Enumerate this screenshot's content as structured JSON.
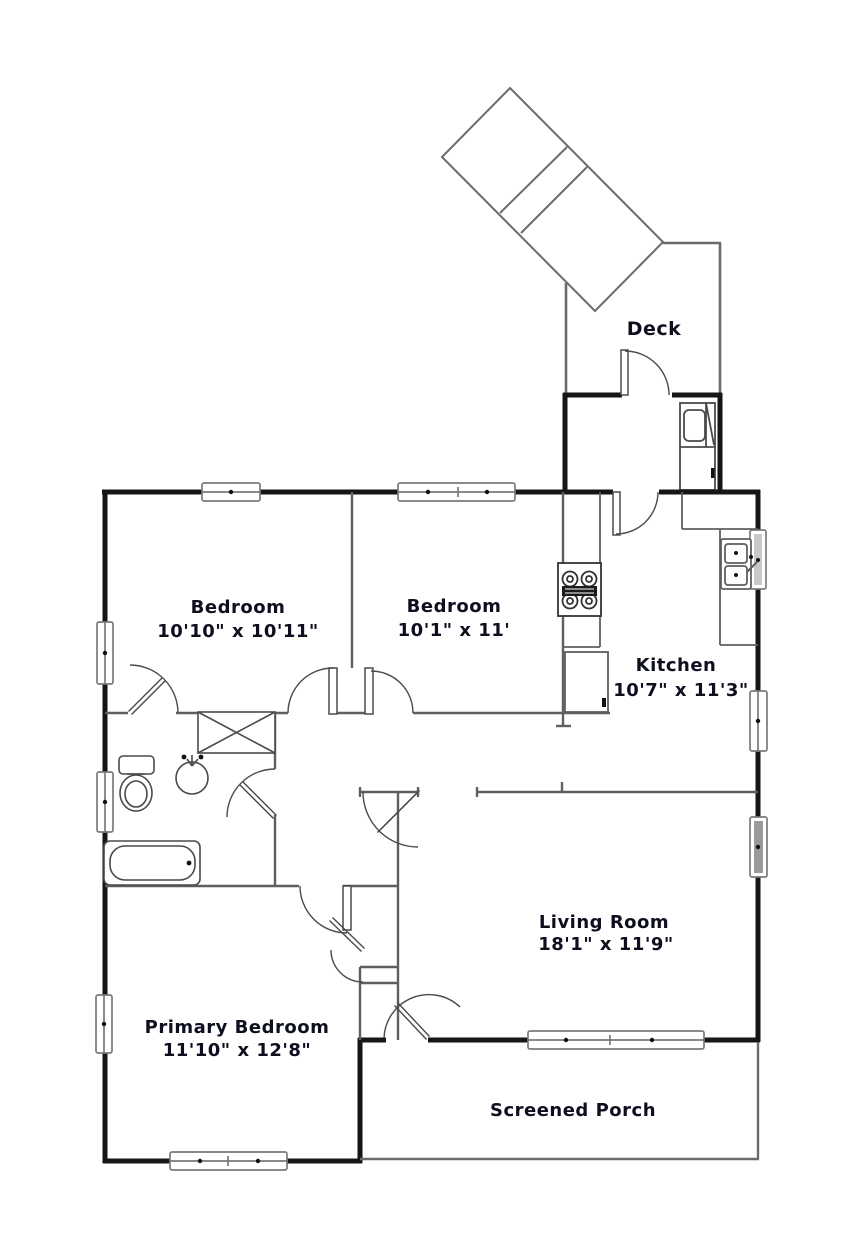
{
  "title": "Floor plan",
  "colors": {
    "outer_wall": "#161616",
    "interior_wall": "#5f5f5f",
    "fixture": "#4a4a4a",
    "label": "#0d0f1f",
    "window_frame": "#7a7a7a",
    "shaded_window": "#9a9a9a"
  },
  "rooms": {
    "deck": {
      "name": "Deck"
    },
    "bedroom1": {
      "name": "Bedroom",
      "dims": "10'10\" x 10'11\""
    },
    "bedroom2": {
      "name": "Bedroom",
      "dims": "10'1\" x 11'"
    },
    "kitchen": {
      "name": "Kitchen",
      "dims": "10'7\" x 11'3\""
    },
    "living_room": {
      "name": "Living Room",
      "dims": "18'1\" x 11'9\""
    },
    "primary_bedroom": {
      "name": "Primary Bedroom",
      "dims": "11'10\" x 12'8\""
    },
    "screened_porch": {
      "name": "Screened Porch"
    }
  }
}
